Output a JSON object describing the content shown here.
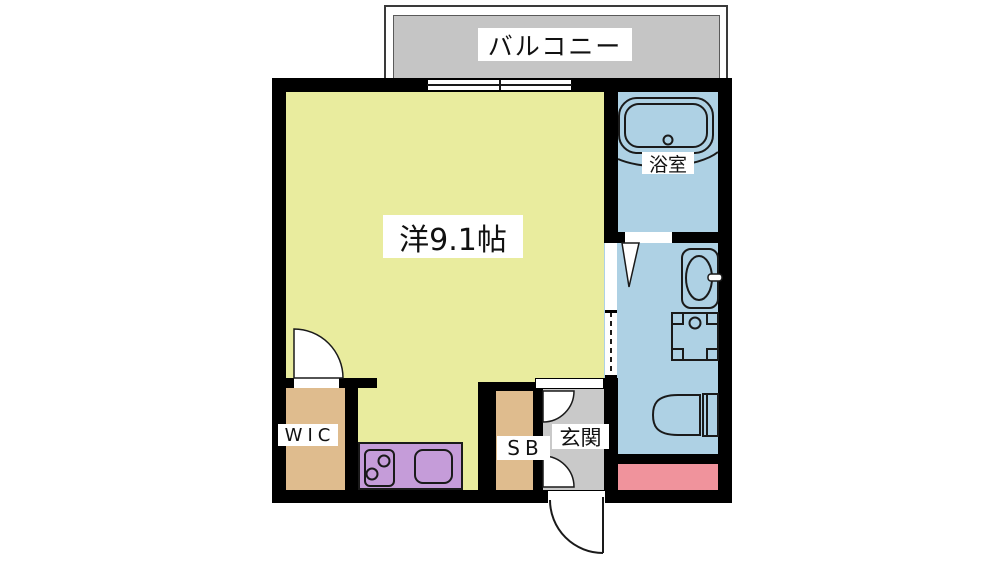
{
  "floorplan": {
    "balcony": {
      "label": "バルコニー"
    },
    "main_room": {
      "label": "洋9.1帖"
    },
    "bathroom": {
      "label": "浴室"
    },
    "wic": {
      "label": "WIC"
    },
    "shoe_box": {
      "label": "SB"
    },
    "entrance": {
      "label": "玄関"
    },
    "colors": {
      "wall": "#000000",
      "room_yellow": "#e9ec9e",
      "wet_area_blue": "#aed1e4",
      "closet_tan": "#dfbc8e",
      "kitchen_purple": "#c59cd9",
      "porch_pink": "#f0939c",
      "balcony_gray": "#c5c5c5",
      "entrance_gray": "#c9c9c9"
    }
  }
}
